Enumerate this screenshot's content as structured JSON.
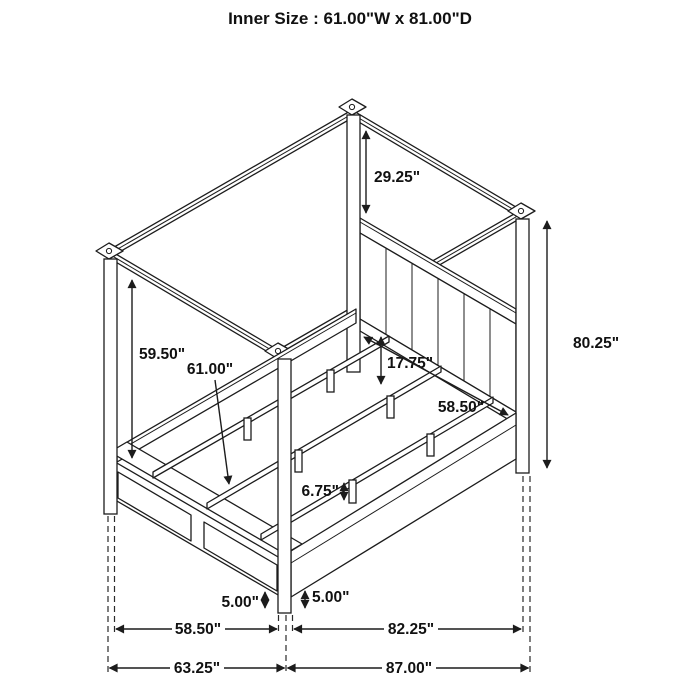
{
  "title": "Inner Size : 61.00\"W x 81.00\"D",
  "dims": {
    "canopy_to_headboard": "29.25\"",
    "overall_height": "80.25\"",
    "under_canopy_clearance": "59.50\"",
    "inner_width": "61.00\"",
    "rail_height": "17.75\"",
    "headboard_width": "58.50\"",
    "slat_leg_height": "6.75\"",
    "foot_clearance_left": "5.00\"",
    "foot_clearance_right": "5.00\"",
    "footboard_width": "58.50\"",
    "side_rail_length": "82.25\"",
    "overall_width": "63.25\"",
    "overall_depth": "87.00\""
  },
  "colors": {
    "line": "#1c1c1c",
    "background": "#ffffff",
    "text": "#111111"
  }
}
